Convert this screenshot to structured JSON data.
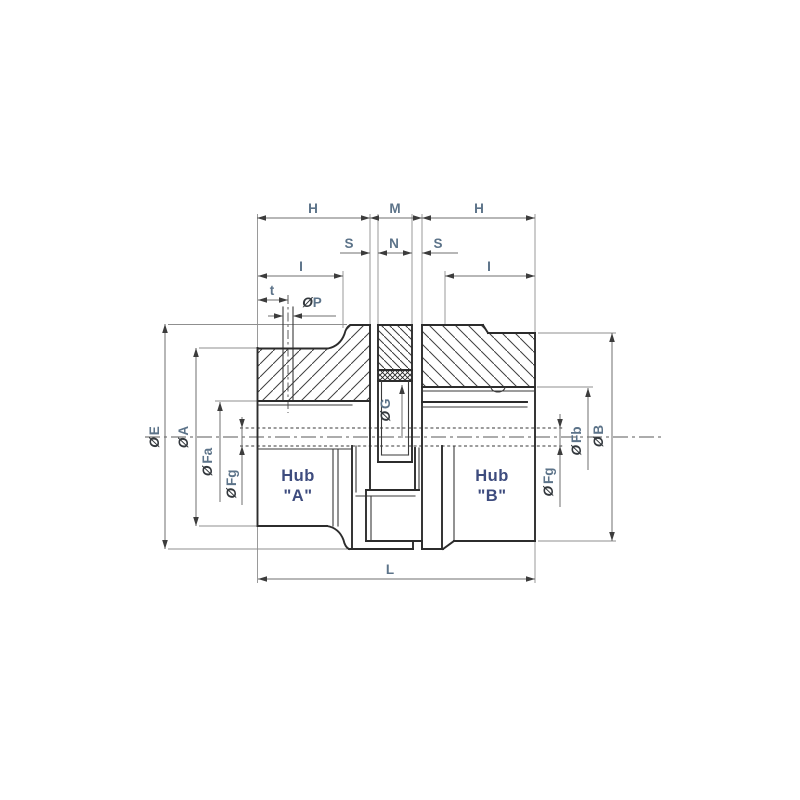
{
  "drawing": {
    "description": "Sectioned assembly drawing of a flexible jaw coupling with two hubs and center spider sleeve",
    "dimension_labels": {
      "h_left": "H",
      "m": "M",
      "h_right": "H",
      "s_left": "S",
      "n": "N",
      "s_right": "S",
      "i_left": "I",
      "i_right": "I",
      "t": "t",
      "l": "L",
      "dia_symbol": "Ø",
      "p": "P",
      "e": "E",
      "a": "A",
      "fa": "Fa",
      "fg_left": "Fg",
      "g": "G",
      "fg_right": "Fg",
      "fb": "Fb",
      "b": "B"
    },
    "part_labels": {
      "hub_a_line1": "Hub",
      "hub_a_line2": "\"A\"",
      "hub_b_line1": "Hub",
      "hub_b_line2": "\"B\""
    },
    "colors": {
      "background": "#ffffff",
      "part_line": "#2c2c2c",
      "dimension_line": "#6f6f6f",
      "label_text": "#5c7389",
      "hub_text": "#3e4c7e",
      "dia_symbol_text": "#33383d"
    }
  }
}
